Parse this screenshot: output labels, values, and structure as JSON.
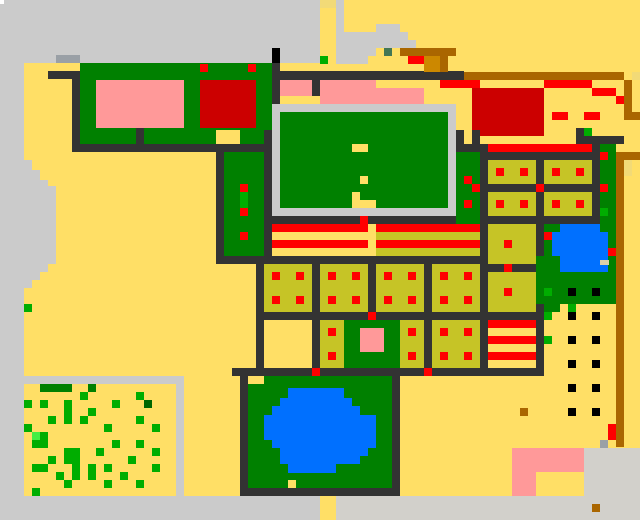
{
  "map_title": "pixel-town-map",
  "canvas": {
    "width": 640,
    "height": 520,
    "background": "#ffdf66"
  },
  "palette": {
    "Y": "#ffdf66",
    "y2": "#f2da77",
    "L": "#cbcbcb",
    "L2": "#d2d0cb",
    "N": "#9aa0a6",
    "D": "#333333",
    "K": "#000000",
    "G": "#008000",
    "g": "#00ad00",
    "gb": "#44ee44",
    "Gd": "#006600",
    "T": "#447755",
    "P": "#ff9999",
    "R": "#ff0000",
    "r": "#cc0000",
    "B": "#aa6600",
    "O": "#cc8800",
    "o": "#c6c426",
    "U": "#0070ff",
    "W": "#ffffff",
    "tan": "#ddd0a8"
  },
  "pixel_rects": [
    [
      0,
      0,
      320,
      63,
      "L",
      "top-left-plaza"
    ],
    [
      336,
      0,
      8,
      32,
      "L"
    ],
    [
      336,
      32,
      40,
      24,
      "L"
    ],
    [
      336,
      56,
      32,
      8,
      "L"
    ],
    [
      376,
      24,
      24,
      8,
      "L"
    ],
    [
      376,
      32,
      32,
      8,
      "L"
    ],
    [
      376,
      40,
      40,
      8,
      "L"
    ],
    [
      0,
      63,
      24,
      97,
      "L"
    ],
    [
      0,
      160,
      32,
      10,
      "L"
    ],
    [
      0,
      170,
      40,
      10,
      "L"
    ],
    [
      0,
      180,
      48,
      6,
      "L"
    ],
    [
      0,
      186,
      56,
      74,
      "L"
    ],
    [
      0,
      260,
      56,
      4,
      "L"
    ],
    [
      0,
      263,
      48,
      9,
      "L"
    ],
    [
      0,
      272,
      40,
      8,
      "L"
    ],
    [
      0,
      280,
      32,
      8,
      "L"
    ],
    [
      0,
      288,
      24,
      88,
      "L",
      "west-gray-road"
    ],
    [
      0,
      376,
      184,
      8,
      "L"
    ],
    [
      0,
      384,
      24,
      112,
      "L"
    ],
    [
      176,
      384,
      8,
      112,
      "L"
    ],
    [
      0,
      0,
      4,
      4,
      "W",
      "white-dot"
    ],
    [
      56,
      55,
      24,
      8,
      "N",
      "gray-block"
    ],
    [
      80,
      63,
      192,
      81,
      "G",
      "nw-building-green"
    ],
    [
      200,
      64,
      8,
      8,
      "R"
    ],
    [
      248,
      64,
      8,
      8,
      "R"
    ],
    [
      96,
      80,
      88,
      48,
      "P",
      "nw-building-pink"
    ],
    [
      200,
      80,
      56,
      48,
      "r",
      "nw-building-red"
    ],
    [
      216,
      130,
      24,
      14,
      "Y"
    ],
    [
      136,
      128,
      8,
      16,
      "D"
    ],
    [
      48,
      71,
      32,
      8,
      "D"
    ],
    [
      72,
      79,
      8,
      73,
      "D"
    ],
    [
      72,
      144,
      192,
      8,
      "D"
    ],
    [
      272,
      48,
      8,
      15,
      "K",
      "black-post"
    ],
    [
      272,
      63,
      8,
      41,
      "D"
    ],
    [
      280,
      71,
      184,
      9,
      "D"
    ],
    [
      280,
      80,
      32,
      16,
      "P"
    ],
    [
      312,
      80,
      8,
      16,
      "D"
    ],
    [
      320,
      80,
      56,
      24,
      "P",
      "mid-pink-building"
    ],
    [
      376,
      88,
      48,
      16,
      "P"
    ],
    [
      440,
      80,
      40,
      8,
      "R"
    ],
    [
      472,
      88,
      8,
      48,
      "r"
    ],
    [
      320,
      56,
      8,
      8,
      "g"
    ],
    [
      320,
      0,
      16,
      8,
      "y2"
    ],
    [
      376,
      48,
      8,
      8,
      "Y"
    ],
    [
      392,
      48,
      8,
      8,
      "Y"
    ],
    [
      384,
      48,
      8,
      8,
      "T",
      "teal-cell"
    ],
    [
      400,
      48,
      56,
      8,
      "B"
    ],
    [
      432,
      56,
      16,
      16,
      "B"
    ],
    [
      408,
      56,
      16,
      8,
      "R"
    ],
    [
      424,
      56,
      16,
      16,
      "O",
      "orange-cell"
    ],
    [
      464,
      72,
      160,
      8,
      "B",
      "north-brown-road"
    ],
    [
      632,
      72,
      8,
      8,
      "y2"
    ],
    [
      624,
      80,
      8,
      32,
      "B"
    ],
    [
      624,
      112,
      16,
      8,
      "B"
    ],
    [
      592,
      88,
      24,
      8,
      "R"
    ],
    [
      616,
      96,
      8,
      8,
      "R"
    ],
    [
      480,
      88,
      64,
      48,
      "r",
      "ne-red-building"
    ],
    [
      544,
      80,
      48,
      8,
      "R"
    ],
    [
      552,
      112,
      16,
      8,
      "R"
    ],
    [
      584,
      112,
      16,
      8,
      "R"
    ],
    [
      272,
      104,
      184,
      8,
      "L"
    ],
    [
      272,
      112,
      8,
      96,
      "L"
    ],
    [
      448,
      104,
      8,
      112,
      "L"
    ],
    [
      272,
      208,
      184,
      8,
      "L"
    ],
    [
      280,
      112,
      168,
      96,
      "G",
      "central-hall"
    ],
    [
      352,
      144,
      16,
      8,
      "Y"
    ],
    [
      360,
      176,
      8,
      8,
      "Y"
    ],
    [
      352,
      192,
      8,
      8,
      "Y"
    ],
    [
      352,
      200,
      24,
      8,
      "Y"
    ],
    [
      264,
      130,
      8,
      134,
      "D"
    ],
    [
      264,
      216,
      216,
      8,
      "D"
    ],
    [
      360,
      216,
      8,
      8,
      "R"
    ],
    [
      456,
      130,
      24,
      22,
      "D"
    ],
    [
      464,
      130,
      8,
      14,
      "Y"
    ],
    [
      456,
      152,
      24,
      72,
      "G",
      "east-hedge"
    ],
    [
      464,
      176,
      8,
      8,
      "R"
    ],
    [
      472,
      184,
      8,
      8,
      "R"
    ],
    [
      464,
      200,
      8,
      8,
      "R"
    ],
    [
      272,
      224,
      96,
      8,
      "R",
      "stripe-house-west"
    ],
    [
      272,
      232,
      96,
      8,
      "Y"
    ],
    [
      272,
      240,
      96,
      8,
      "R"
    ],
    [
      272,
      248,
      96,
      8,
      "Y"
    ],
    [
      376,
      224,
      104,
      8,
      "R",
      "stripe-house-east"
    ],
    [
      376,
      232,
      104,
      8,
      "o"
    ],
    [
      376,
      240,
      104,
      8,
      "R"
    ],
    [
      376,
      248,
      104,
      8,
      "o"
    ],
    [
      216,
      256,
      264,
      8,
      "D"
    ],
    [
      312,
      256,
      8,
      8,
      "R"
    ],
    [
      424,
      256,
      8,
      8,
      "R"
    ],
    [
      216,
      152,
      8,
      104,
      "D"
    ],
    [
      224,
      152,
      40,
      104,
      "G",
      "west-hedge"
    ],
    [
      240,
      184,
      8,
      8,
      "R"
    ],
    [
      240,
      192,
      8,
      16,
      "g"
    ],
    [
      240,
      208,
      8,
      8,
      "R"
    ],
    [
      240,
      232,
      8,
      8,
      "R"
    ],
    [
      256,
      256,
      8,
      112,
      "D"
    ],
    [
      312,
      256,
      8,
      112,
      "D"
    ],
    [
      368,
      256,
      8,
      64,
      "D"
    ],
    [
      424,
      256,
      8,
      112,
      "D"
    ],
    [
      264,
      264,
      48,
      48,
      "o",
      "field-plot"
    ],
    [
      320,
      264,
      48,
      48,
      "o",
      "field-plot"
    ],
    [
      376,
      264,
      48,
      48,
      "o",
      "field-plot"
    ],
    [
      432,
      264,
      48,
      48,
      "o",
      "field-plot"
    ],
    [
      264,
      312,
      216,
      8,
      "D"
    ],
    [
      368,
      312,
      8,
      8,
      "R"
    ],
    [
      320,
      320,
      24,
      48,
      "o",
      "field-plot"
    ],
    [
      344,
      320,
      56,
      48,
      "G",
      "shrine-lawn"
    ],
    [
      360,
      328,
      24,
      24,
      "P",
      "pink-shrine"
    ],
    [
      400,
      320,
      24,
      48,
      "o",
      "field-plot"
    ],
    [
      432,
      320,
      48,
      48,
      "o",
      "field-plot"
    ],
    [
      232,
      368,
      248,
      8,
      "D"
    ],
    [
      312,
      368,
      8,
      8,
      "R"
    ],
    [
      424,
      368,
      8,
      8,
      "R"
    ],
    [
      272,
      272,
      8,
      8,
      "R"
    ],
    [
      296,
      272,
      8,
      8,
      "R"
    ],
    [
      328,
      272,
      8,
      8,
      "R"
    ],
    [
      352,
      272,
      8,
      8,
      "R"
    ],
    [
      384,
      272,
      8,
      8,
      "R"
    ],
    [
      408,
      272,
      8,
      8,
      "R"
    ],
    [
      440,
      272,
      8,
      8,
      "R"
    ],
    [
      464,
      272,
      8,
      8,
      "R"
    ],
    [
      272,
      296,
      8,
      8,
      "R"
    ],
    [
      296,
      296,
      8,
      8,
      "R"
    ],
    [
      328,
      296,
      8,
      8,
      "R"
    ],
    [
      352,
      296,
      8,
      8,
      "R"
    ],
    [
      384,
      296,
      8,
      8,
      "R"
    ],
    [
      408,
      296,
      8,
      8,
      "R"
    ],
    [
      440,
      296,
      8,
      8,
      "R"
    ],
    [
      464,
      296,
      8,
      8,
      "R"
    ],
    [
      328,
      328,
      8,
      8,
      "R"
    ],
    [
      328,
      352,
      8,
      8,
      "R"
    ],
    [
      408,
      328,
      8,
      8,
      "R"
    ],
    [
      408,
      352,
      8,
      8,
      "R"
    ],
    [
      440,
      328,
      8,
      8,
      "R"
    ],
    [
      464,
      328,
      8,
      8,
      "R"
    ],
    [
      440,
      352,
      8,
      8,
      "R"
    ],
    [
      464,
      352,
      8,
      8,
      "R"
    ],
    [
      480,
      144,
      8,
      232,
      "D"
    ],
    [
      488,
      144,
      104,
      8,
      "R",
      "east-red-road"
    ],
    [
      488,
      152,
      104,
      8,
      "D"
    ],
    [
      576,
      128,
      8,
      16,
      "D"
    ],
    [
      584,
      128,
      8,
      8,
      "g"
    ],
    [
      576,
      136,
      48,
      8,
      "D"
    ],
    [
      488,
      160,
      48,
      24,
      "o",
      "field-plot"
    ],
    [
      544,
      160,
      48,
      24,
      "o",
      "field-plot"
    ],
    [
      488,
      192,
      48,
      24,
      "o",
      "field-plot"
    ],
    [
      544,
      192,
      48,
      24,
      "o",
      "field-plot"
    ],
    [
      536,
      160,
      8,
      24,
      "D"
    ],
    [
      536,
      192,
      8,
      24,
      "D"
    ],
    [
      488,
      184,
      104,
      8,
      "D"
    ],
    [
      536,
      184,
      8,
      8,
      "R"
    ],
    [
      488,
      216,
      104,
      8,
      "D"
    ],
    [
      496,
      168,
      8,
      8,
      "R"
    ],
    [
      520,
      168,
      8,
      8,
      "R"
    ],
    [
      552,
      168,
      8,
      8,
      "R"
    ],
    [
      576,
      168,
      8,
      8,
      "R"
    ],
    [
      496,
      200,
      8,
      8,
      "R"
    ],
    [
      520,
      200,
      8,
      8,
      "R"
    ],
    [
      552,
      200,
      8,
      8,
      "R"
    ],
    [
      576,
      200,
      8,
      8,
      "R"
    ],
    [
      592,
      144,
      8,
      120,
      "D"
    ],
    [
      600,
      144,
      16,
      112,
      "G",
      "east-green-lane"
    ],
    [
      600,
      152,
      8,
      8,
      "R"
    ],
    [
      600,
      184,
      8,
      8,
      "R"
    ],
    [
      600,
      208,
      8,
      8,
      "g"
    ],
    [
      616,
      152,
      24,
      8,
      "B"
    ],
    [
      616,
      160,
      8,
      287,
      "B",
      "east-brown-road"
    ],
    [
      624,
      160,
      8,
      16,
      "y2"
    ],
    [
      536,
      216,
      8,
      160,
      "D"
    ],
    [
      488,
      224,
      48,
      40,
      "o",
      "field-plot"
    ],
    [
      504,
      240,
      8,
      8,
      "R"
    ],
    [
      488,
      264,
      48,
      8,
      "D"
    ],
    [
      504,
      264,
      8,
      8,
      "R"
    ],
    [
      488,
      272,
      48,
      40,
      "o",
      "field-plot"
    ],
    [
      504,
      288,
      8,
      8,
      "R"
    ],
    [
      488,
      312,
      48,
      8,
      "D"
    ],
    [
      488,
      320,
      48,
      8,
      "R",
      "stripe-house-south"
    ],
    [
      488,
      336,
      48,
      8,
      "R"
    ],
    [
      488,
      352,
      48,
      8,
      "R"
    ],
    [
      480,
      368,
      64,
      8,
      "D"
    ],
    [
      544,
      224,
      16,
      88,
      "G"
    ],
    [
      544,
      232,
      8,
      8,
      "R"
    ],
    [
      544,
      256,
      8,
      8,
      "R"
    ],
    [
      536,
      256,
      80,
      48,
      "G",
      "pond-park"
    ],
    [
      560,
      224,
      40,
      8,
      "U"
    ],
    [
      552,
      232,
      56,
      24,
      "U",
      "east-pond"
    ],
    [
      560,
      256,
      48,
      16,
      "U"
    ],
    [
      600,
      260,
      9,
      5,
      "tan"
    ],
    [
      608,
      248,
      8,
      8,
      "R"
    ],
    [
      568,
      288,
      8,
      8,
      "K"
    ],
    [
      592,
      288,
      8,
      8,
      "K"
    ],
    [
      544,
      288,
      8,
      8,
      "g"
    ],
    [
      568,
      304,
      8,
      8,
      "g"
    ],
    [
      544,
      312,
      8,
      8,
      "g"
    ],
    [
      568,
      312,
      8,
      8,
      "K"
    ],
    [
      592,
      312,
      8,
      8,
      "K"
    ],
    [
      568,
      336,
      8,
      8,
      "K"
    ],
    [
      592,
      336,
      8,
      8,
      "K"
    ],
    [
      568,
      360,
      8,
      8,
      "K"
    ],
    [
      592,
      360,
      8,
      8,
      "K"
    ],
    [
      568,
      384,
      8,
      8,
      "K"
    ],
    [
      592,
      384,
      8,
      8,
      "K"
    ],
    [
      568,
      408,
      8,
      8,
      "K"
    ],
    [
      592,
      408,
      8,
      8,
      "K"
    ],
    [
      544,
      336,
      8,
      8,
      "g"
    ],
    [
      520,
      408,
      8,
      8,
      "B"
    ],
    [
      608,
      424,
      8,
      16,
      "R",
      "red-marker"
    ],
    [
      600,
      440,
      8,
      8,
      "N"
    ],
    [
      248,
      376,
      152,
      112,
      "G",
      "south-park"
    ],
    [
      240,
      376,
      8,
      112,
      "D"
    ],
    [
      392,
      376,
      8,
      112,
      "D"
    ],
    [
      240,
      488,
      160,
      8,
      "D"
    ],
    [
      248,
      376,
      16,
      8,
      "Y"
    ],
    [
      288,
      388,
      56,
      10,
      "U",
      "south-pond"
    ],
    [
      280,
      398,
      72,
      8,
      "U"
    ],
    [
      272,
      406,
      88,
      9,
      "U"
    ],
    [
      264,
      415,
      112,
      25,
      "U"
    ],
    [
      272,
      440,
      104,
      8,
      "U"
    ],
    [
      280,
      448,
      88,
      8,
      "U"
    ],
    [
      280,
      456,
      80,
      8,
      "U"
    ],
    [
      288,
      464,
      48,
      9,
      "U"
    ],
    [
      288,
      480,
      8,
      8,
      "Y"
    ],
    [
      24,
      304,
      8,
      8,
      "g"
    ],
    [
      40,
      384,
      32,
      8,
      "G",
      "meadow-hedge"
    ],
    [
      88,
      384,
      8,
      8,
      "G"
    ],
    [
      80,
      392,
      8,
      8,
      "g"
    ],
    [
      136,
      392,
      8,
      8,
      "g"
    ],
    [
      24,
      400,
      8,
      8,
      "g"
    ],
    [
      40,
      400,
      8,
      8,
      "g"
    ],
    [
      64,
      400,
      8,
      16,
      "g"
    ],
    [
      112,
      400,
      8,
      8,
      "g"
    ],
    [
      144,
      400,
      8,
      8,
      "Gd"
    ],
    [
      88,
      408,
      8,
      8,
      "g"
    ],
    [
      48,
      416,
      8,
      8,
      "g"
    ],
    [
      64,
      416,
      8,
      8,
      "g"
    ],
    [
      80,
      416,
      8,
      8,
      "g"
    ],
    [
      136,
      416,
      8,
      8,
      "g"
    ],
    [
      24,
      424,
      8,
      8,
      "g"
    ],
    [
      104,
      424,
      8,
      8,
      "g"
    ],
    [
      152,
      424,
      8,
      8,
      "g"
    ],
    [
      32,
      432,
      8,
      8,
      "gb"
    ],
    [
      40,
      432,
      8,
      16,
      "g"
    ],
    [
      32,
      440,
      8,
      8,
      "g"
    ],
    [
      112,
      440,
      8,
      8,
      "g"
    ],
    [
      136,
      440,
      8,
      8,
      "g"
    ],
    [
      64,
      448,
      16,
      16,
      "g"
    ],
    [
      96,
      448,
      8,
      8,
      "g"
    ],
    [
      152,
      448,
      8,
      8,
      "g"
    ],
    [
      48,
      456,
      8,
      8,
      "g"
    ],
    [
      128,
      456,
      8,
      8,
      "g"
    ],
    [
      32,
      464,
      8,
      8,
      "g"
    ],
    [
      40,
      464,
      8,
      8,
      "g"
    ],
    [
      72,
      464,
      8,
      8,
      "g"
    ],
    [
      88,
      464,
      8,
      16,
      "g"
    ],
    [
      104,
      464,
      8,
      8,
      "g"
    ],
    [
      152,
      464,
      8,
      8,
      "g"
    ],
    [
      56,
      472,
      8,
      8,
      "g"
    ],
    [
      72,
      472,
      8,
      8,
      "g"
    ],
    [
      120,
      472,
      8,
      8,
      "g"
    ],
    [
      64,
      480,
      8,
      8,
      "g"
    ],
    [
      104,
      480,
      8,
      8,
      "g"
    ],
    [
      136,
      480,
      8,
      8,
      "g"
    ],
    [
      32,
      488,
      8,
      8,
      "g"
    ],
    [
      0,
      496,
      320,
      24,
      "L",
      "south-gray-band"
    ],
    [
      336,
      496,
      304,
      24,
      "L2"
    ],
    [
      320,
      496,
      16,
      24,
      "Y",
      "south-gate"
    ],
    [
      584,
      448,
      56,
      48,
      "L2",
      "se-plaza"
    ],
    [
      512,
      448,
      72,
      24,
      "P",
      "se-pink-building"
    ],
    [
      512,
      472,
      24,
      24,
      "P"
    ],
    [
      536,
      472,
      16,
      24,
      "Y"
    ],
    [
      592,
      504,
      8,
      8,
      "B"
    ]
  ]
}
